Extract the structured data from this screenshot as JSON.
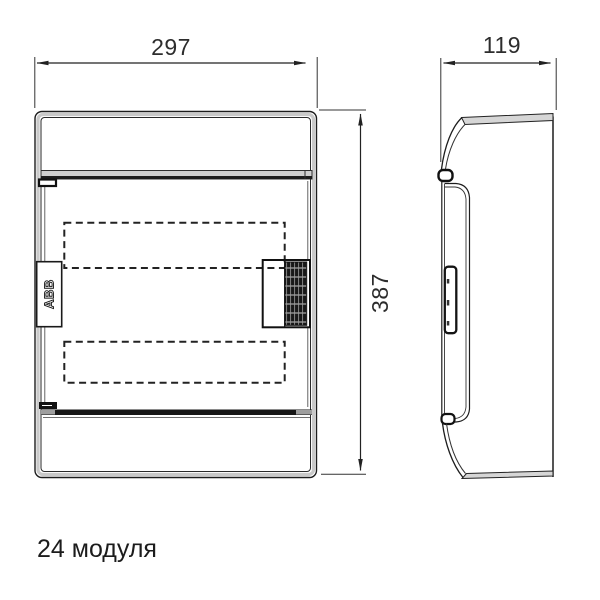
{
  "drawing": {
    "caption": "24 модуля",
    "brand_label": "ABB",
    "dimensions": {
      "front_width_mm": "297",
      "front_height_mm": "387",
      "side_depth_mm": "119"
    },
    "views": {
      "front": "front-view-of-enclosure",
      "side": "side-view-of-enclosure"
    },
    "colors": {
      "line": "#222222",
      "gray_band": "#cccccc",
      "hatch_dark": "#181818",
      "text": "#2d2d2d",
      "background": "#ffffff"
    }
  }
}
